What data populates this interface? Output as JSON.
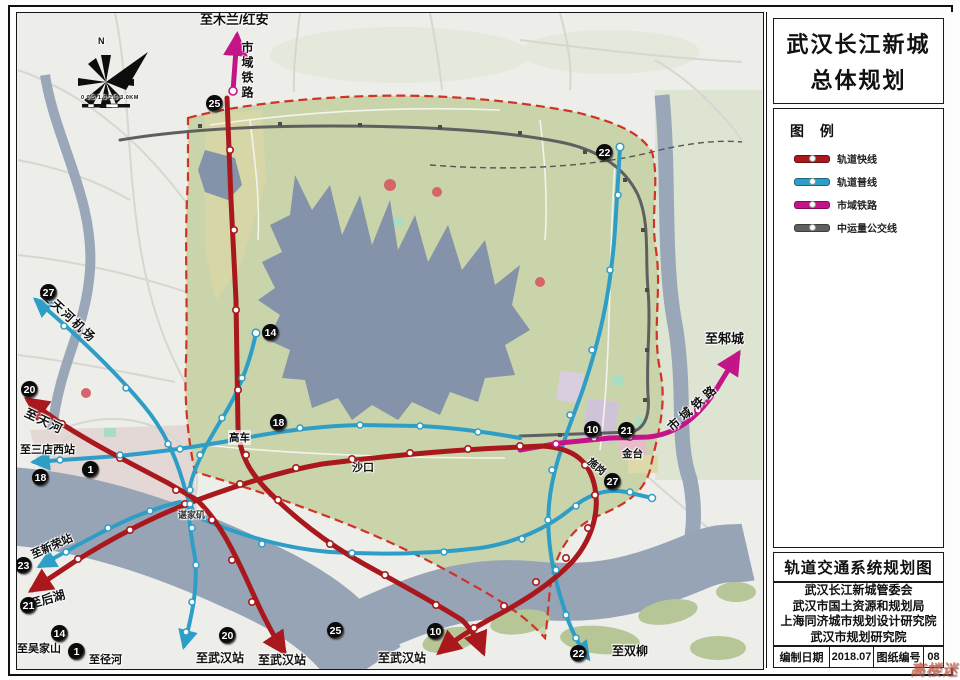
{
  "panel": {
    "title_line1": "武汉长江新城",
    "title_line2": "总体规划",
    "legend": {
      "title": "图  例",
      "items": [
        {
          "label": "轨道快线",
          "color": "#a8181d"
        },
        {
          "label": "轨道普线",
          "color": "#2e9ec7"
        },
        {
          "label": "市域铁路",
          "color": "#c41588"
        },
        {
          "label": "中运量公交线",
          "color": "#5f5f5f"
        }
      ]
    },
    "drawing_title": "轨道交通系统规划图",
    "organizations": [
      "武汉长江新城管委会",
      "武汉市国土资源和规划局",
      "上海同济城市规划设计研究院",
      "武汉市规划研究院"
    ],
    "footer": {
      "date_label": "编制日期",
      "date_value": "2018.07",
      "sheet_label": "图纸编号",
      "sheet_value": "08"
    }
  },
  "map": {
    "compass_label": "N",
    "scale_text": "0 0.5 1.0   2.0   3.0KM",
    "watermark": "高楼迷",
    "labels": [
      {
        "text": "至木兰/红安"
      },
      {
        "text": "市域铁路"
      },
      {
        "text": "至邾城"
      },
      {
        "text": "市域铁路"
      },
      {
        "text": "至天河机场"
      },
      {
        "text": "至天河"
      },
      {
        "text": "至三店西站"
      },
      {
        "text": "至新荣站"
      },
      {
        "text": "至后湖"
      },
      {
        "text": "至吴家山"
      },
      {
        "text": "至径河"
      },
      {
        "text": "至武汉站"
      },
      {
        "text": "至武汉站"
      },
      {
        "text": "至武汉站"
      },
      {
        "text": "至双柳"
      },
      {
        "text": "高车"
      },
      {
        "text": "沙口"
      },
      {
        "text": "金台"
      },
      {
        "text": "施岗"
      },
      {
        "text": "谌家矶"
      }
    ],
    "badges": [
      {
        "num": "25"
      },
      {
        "num": "22"
      },
      {
        "num": "14"
      },
      {
        "num": "27"
      },
      {
        "num": "20"
      },
      {
        "num": "18"
      },
      {
        "num": "1"
      },
      {
        "num": "18"
      },
      {
        "num": "23"
      },
      {
        "num": "21"
      },
      {
        "num": "14"
      },
      {
        "num": "1"
      },
      {
        "num": "20"
      },
      {
        "num": "25"
      },
      {
        "num": "10"
      },
      {
        "num": "21"
      },
      {
        "num": "27"
      },
      {
        "num": "10"
      },
      {
        "num": "22"
      }
    ]
  },
  "colors": {
    "rail_fast": "#a8181d",
    "rail_regular": "#2e9ec7",
    "regional_rail": "#c41588",
    "brt": "#5f5f5f",
    "boundary": "#cf3326",
    "water": "#97a4b5",
    "greenland": "#c9d4aa"
  }
}
